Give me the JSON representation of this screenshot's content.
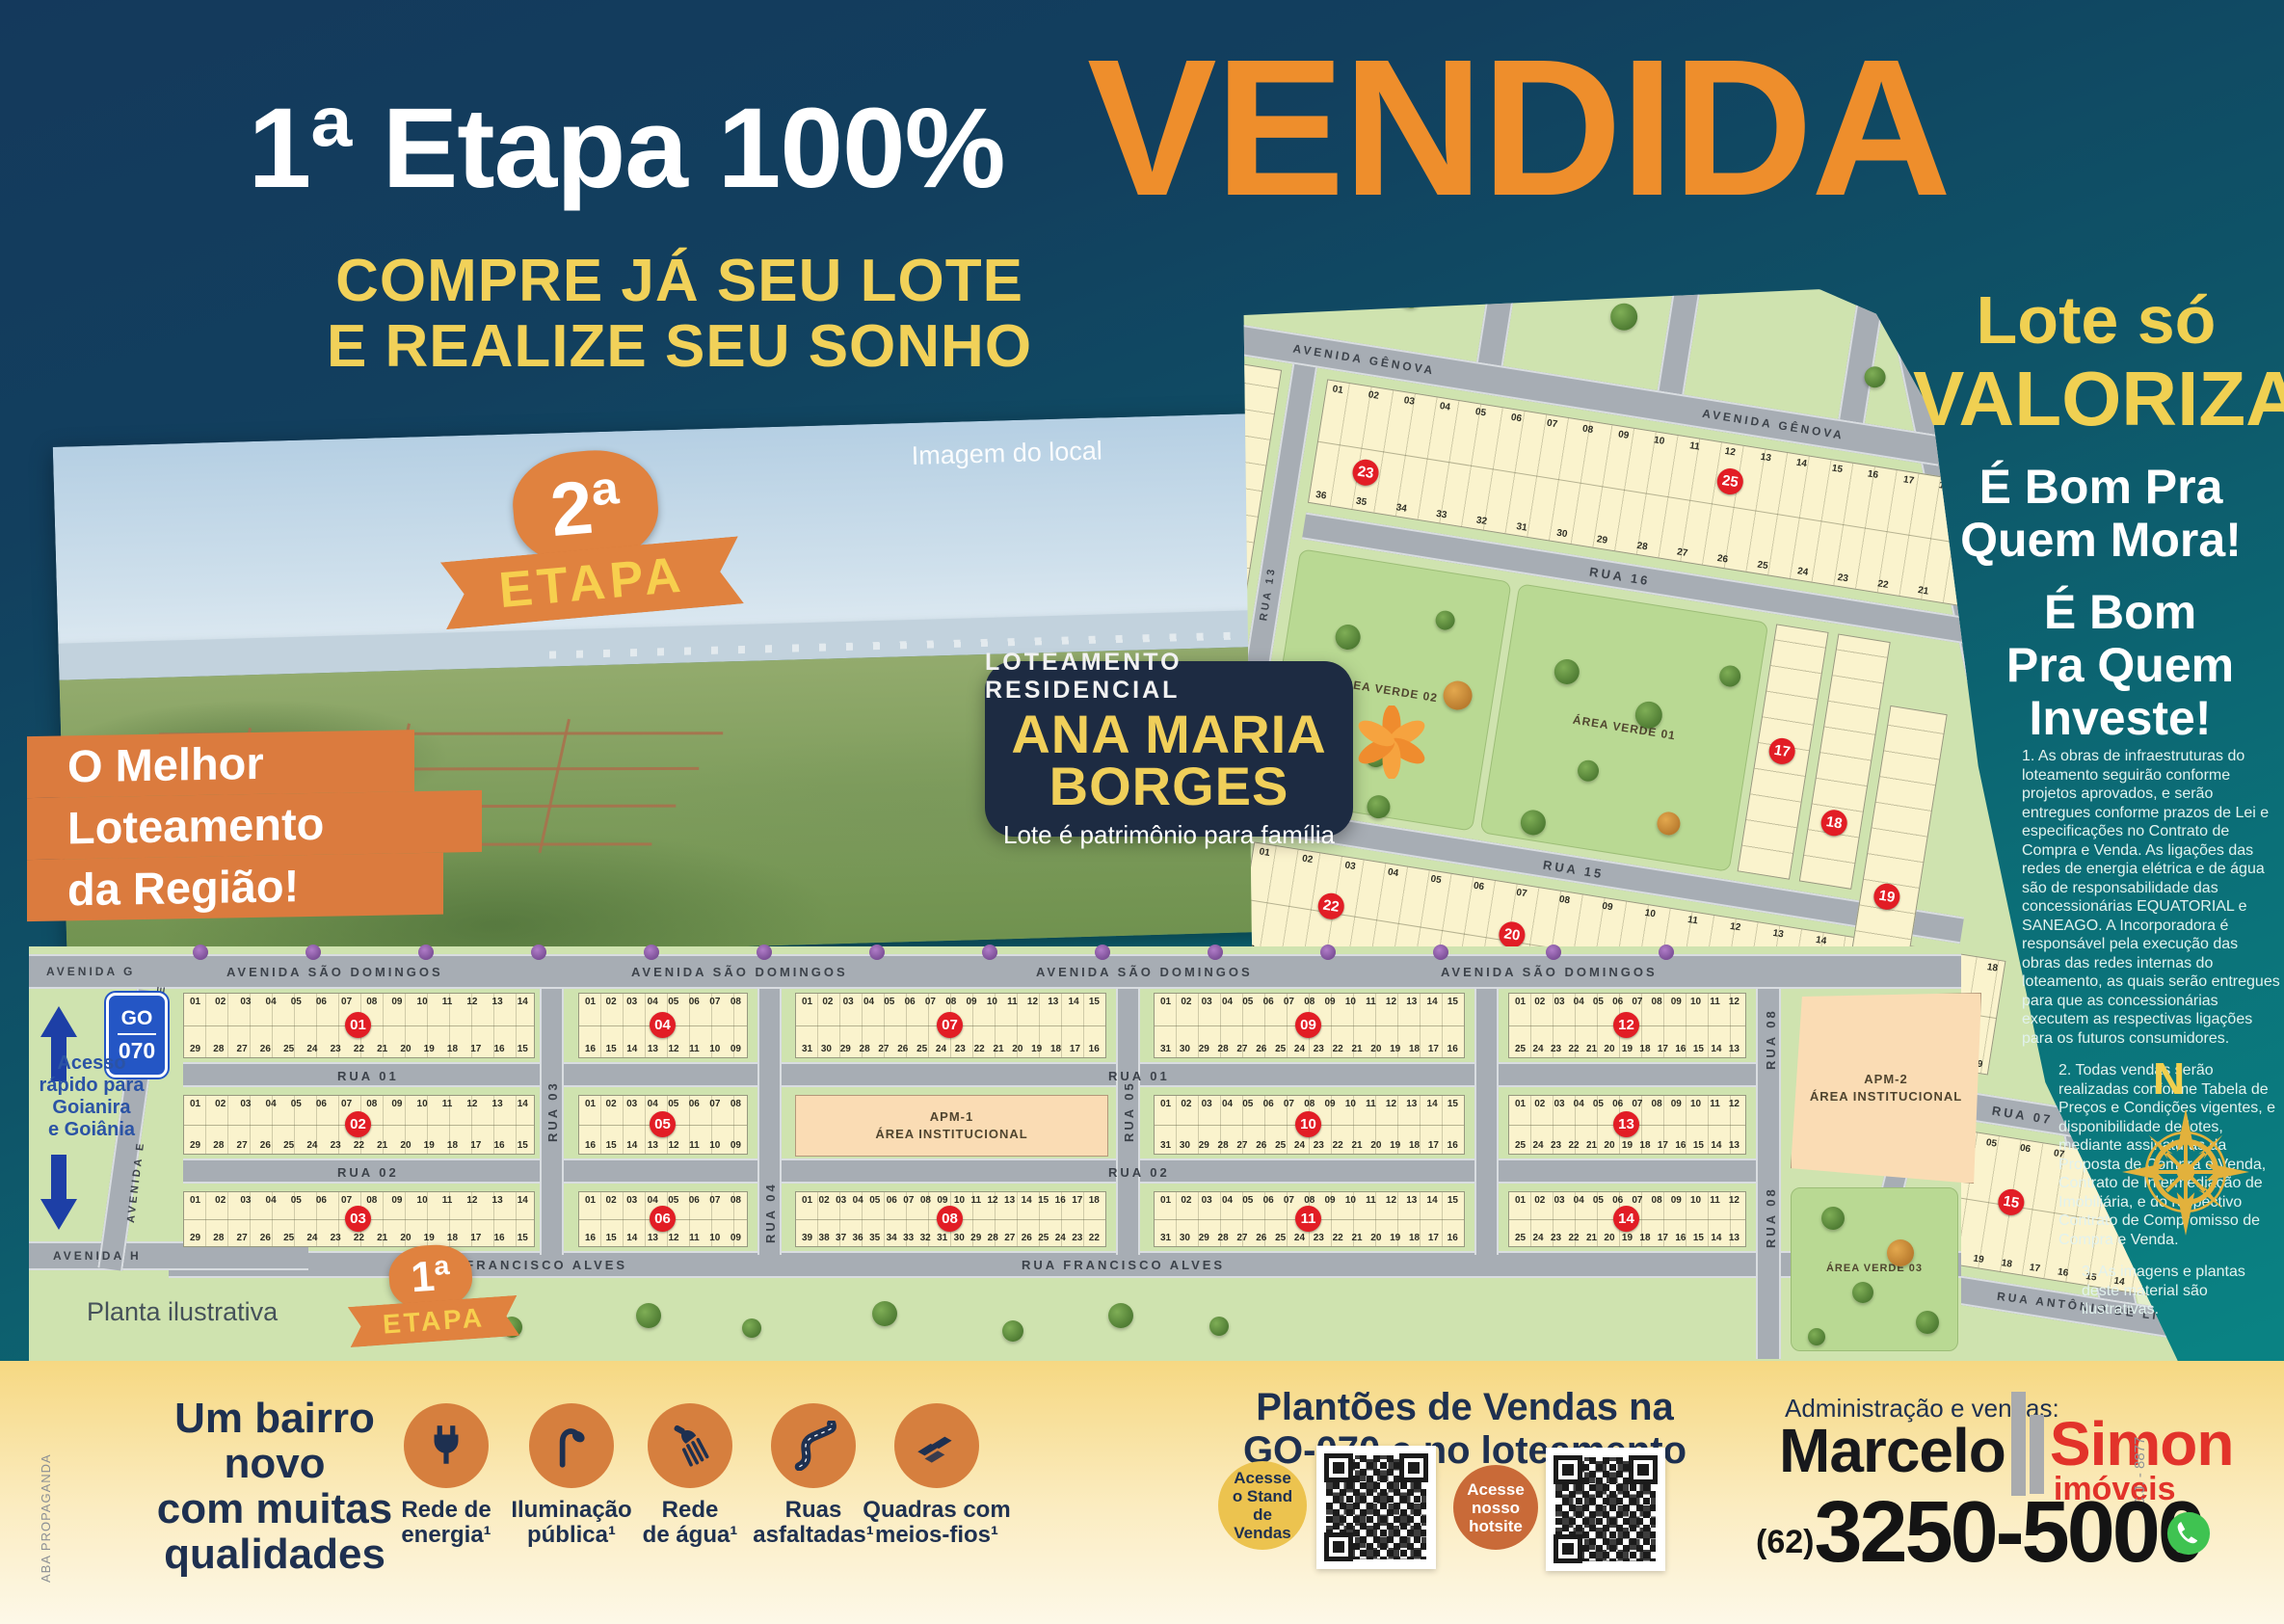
{
  "headline": {
    "stage": "1ª Etapa 100%",
    "sold": "VENDIDA",
    "cta": "COMPRE JÁ SEU LOTE\nE REALIZE SEU SONHO"
  },
  "photo": {
    "caption": "Imagem do local"
  },
  "badges": {
    "stage2": {
      "number": "2ª",
      "label": "ETAPA"
    },
    "stage1": {
      "number": "1ª",
      "label": "ETAPA"
    },
    "ribbon": [
      "O Melhor",
      "Loteamento",
      "da Região!"
    ],
    "project": {
      "kicker": "LOTEAMENTO RESIDENCIAL",
      "name": "ANA MARIA\nBORGES",
      "tagline": "Lote é patrimônio para família"
    }
  },
  "right_column": {
    "value1": "Lote só",
    "value2": "VALORIZA",
    "benefit_mora": "É Bom Pra\nQuem Mora!",
    "benefit_investe": "É Bom\nPra Quem\nInveste!",
    "legal": [
      "1. As obras de infraestruturas do loteamento seguirão conforme projetos aprovados, e serão entregues conforme prazos de Lei e especificações no Contrato de Compra e Venda. As ligações das redes de energia elétrica e de água são de responsabilidade das concessionárias EQUATORIAL e SANEAGO. A Incorporadora é responsável pela execução das obras das redes internas do loteamento, as quais serão entregues para que as concessionárias executem as respectivas ligações para os futuros consumidores.",
      "2. Todas vendas serão realizadas conforme Tabela de Preços e Condições vigentes, e disponibilidade de lotes, mediante assinaturas da Proposta de Compra e Venda, Contrato de Intermediação de Imobiliária, e do respectivo Contrato de Compromisso de Compra e Venda.",
      "3. As imagens e plantas deste material são ilustrativas."
    ],
    "compass": "N"
  },
  "map": {
    "note": "Planta ilustrativa",
    "road_sign": {
      "uf": "GO",
      "number": "070"
    },
    "access": "Acesso\nrápido para\nGoianira\ne Goiânia",
    "labels": {
      "avenida_g": "AVENIDA G",
      "avenida_e": "AVENIDA E",
      "avenida_h": "AVENIDA H",
      "sao_domingos": "AVENIDA SÃO DOMINGOS",
      "rua01": "RUA 01",
      "rua02": "RUA 02",
      "rua03": "RUA 03",
      "rua04": "RUA 04",
      "rua05": "RUA 05",
      "rua07": "RUA 07",
      "rua08": "RUA 08",
      "rua09": "RUA 09",
      "rua13": "RUA 13",
      "rua14": "RUA 14",
      "rua15": "RUA 15",
      "rua16": "RUA 16",
      "francisco": "RUA FRANCISCO ALVES",
      "genova": "AVENIDA GÊNOVA",
      "florenca": "RUA FLORENÇA",
      "jk": "AVENIDA J.K",
      "antonio": "RUA ANTÔNIO DE LIMA"
    },
    "areas": {
      "apm1": "APM-1\nÁREA INSTITUCIONAL",
      "apm2": "APM-2\nÁREA INSTITUCIONAL",
      "verde1": "ÁREA VERDE 01",
      "verde2": "ÁREA VERDE 02",
      "verde3": "ÁREA VERDE 03"
    },
    "quadras": [
      "01",
      "02",
      "03",
      "04",
      "05",
      "06",
      "07",
      "08",
      "09",
      "10",
      "11",
      "12",
      "13",
      "14",
      "15",
      "16",
      "17",
      "18",
      "19",
      "20",
      "21",
      "22",
      "23",
      "24",
      "25"
    ],
    "lot_ranges": {
      "wide14": {
        "top": [
          1,
          14
        ],
        "bottom": [
          29,
          15
        ]
      },
      "narrow8": {
        "top": [
          1,
          8
        ],
        "bottom": [
          16,
          9
        ]
      },
      "mid15": {
        "top": [
          1,
          15
        ],
        "bottom": [
          31,
          16
        ]
      },
      "mid18": {
        "top": [
          1,
          18
        ],
        "bottom": [
          39,
          22
        ]
      },
      "e12": {
        "top": [
          1,
          12
        ],
        "bottom": [
          25,
          13
        ]
      },
      "q25": {
        "top": [
          1,
          19
        ],
        "bottom": [
          36,
          20
        ]
      },
      "q20": {
        "top": [
          1,
          18
        ],
        "bottom": [
          39,
          19
        ]
      },
      "q15": {
        "top": [
          1,
          11
        ],
        "bottom": [
          24,
          12
        ]
      }
    }
  },
  "footer": {
    "aba": "ABA PROPAGANDA",
    "bairro": "Um bairro\nnovo\ncom muitas\nqualidades",
    "features": [
      "Rede de\nenergia¹",
      "Iluminação\npública¹",
      "Rede\nde água¹",
      "Ruas\nasfaltadas¹",
      "Quadras com\nmeios-fios¹"
    ],
    "plantoes": "Plantões de Vendas na\nGO-070 e no loteamento",
    "qr_stand": "Acesse\no Stand\nde\nVendas",
    "qr_hotsite": "Acesse\nnosso\nhotsite",
    "admin": "Administração e vendas:",
    "brand": {
      "first": "Marcelo",
      "second": "Simon",
      "sub": "imóveis",
      "registry": "C.J. - 8877"
    },
    "phone_ddd": "(62)",
    "phone": "3250-5000"
  }
}
